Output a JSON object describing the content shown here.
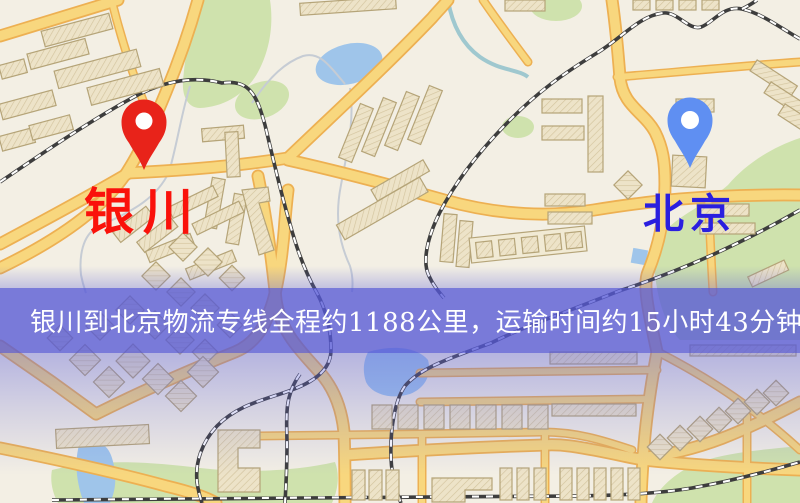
{
  "meta": {
    "type": "logistics-route-map",
    "size": "800x503"
  },
  "markers": {
    "origin": {
      "name": "银川",
      "pin_color": "#e8231a",
      "label_color": "#fa120b",
      "pin_icon": "map-pin"
    },
    "destination": {
      "name": "北京",
      "pin_color": "#5f8ff2",
      "label_color": "#2a1fdf",
      "pin_icon": "map-pin"
    }
  },
  "banner": {
    "text": "银川到北京物流专线全程约1188公里，运输时间约15小时43分钟.",
    "distance": "约1188公里",
    "duration": "约15小时43分钟",
    "background_color": "#5658d6",
    "text_color": "#ffffff"
  },
  "map_colors": {
    "background": "#f3efe4",
    "road_fill": "#f8d77e",
    "road_casing": "#edb052",
    "green_area": "#cfe2ad",
    "water": "#9fc5ea",
    "railway": "#3d3d3d",
    "building_fill": "#ede3c8",
    "building_stroke": "#b5a478",
    "stream": "#c6ccd4"
  }
}
